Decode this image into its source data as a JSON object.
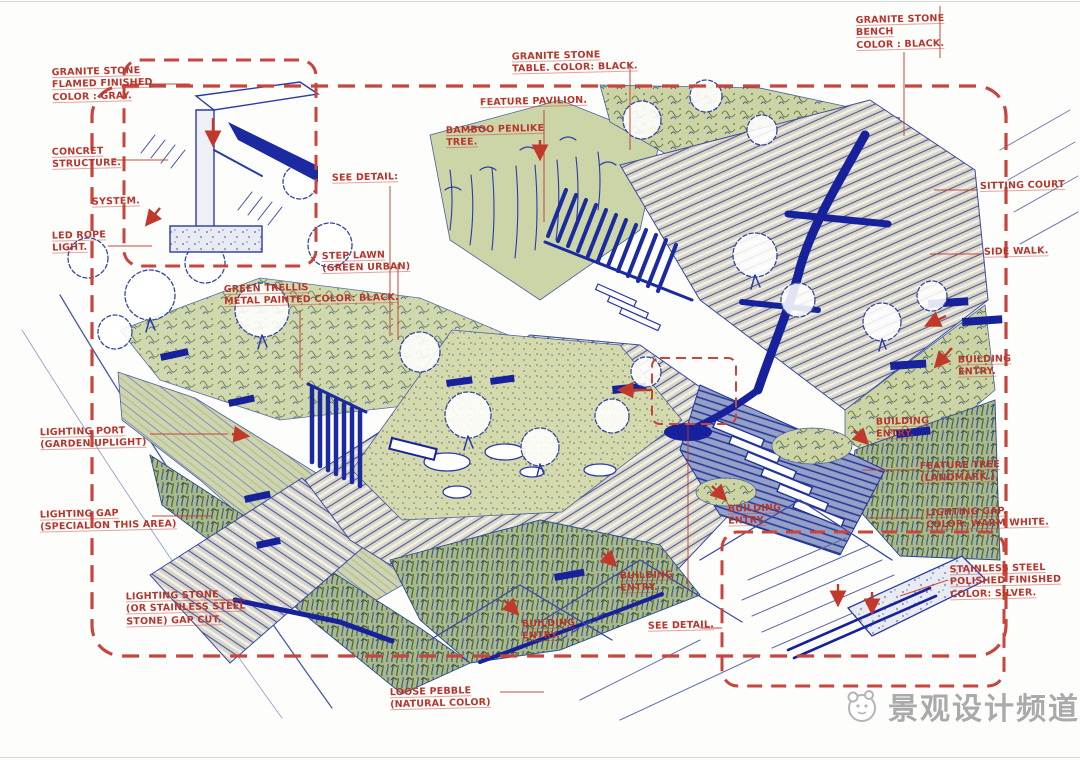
{
  "annotations": {
    "granite_flamed": "GRANITE STONE\nFLAMED FINISHED\nCOLOR : GRAY.",
    "concrete_structure": "CONCRET\nSTRUCTURE.",
    "system": "SYSTEM.",
    "led_rope": "LED ROPE\nLIGHT.",
    "see_detail_left": "SEE DETAIL:",
    "step_lawn": "STEP LAWN\n(GREEN URBAN)",
    "green_trellis": "GREEN TRELLIS\nMETAL PAINTED COLOR: BLACK.",
    "granite_table": "GRANITE STONE\nTABLE. COLOR: BLACK.",
    "feature_pavilion": "FEATURE PAVILION.",
    "bamboo_tree": "BAMBOO PENLIKE\nTREE.",
    "granite_bench": "GRANITE STONE\nBENCH\nCOLOR : BLACK.",
    "sitting_court": "SITTING COURT",
    "side_walk": "SIDE WALK.",
    "building_entry_r1": "BUILDING\nENTRY.",
    "building_entry_r2": "BUILDING\nENTRY.",
    "feature_tree": "FEATURE TREE\n(LANDMARK.)",
    "lighting_gap_warm": "LIGHTING GAP.\nCOLOR: WARM WHITE.",
    "stainless_steel": "STAINLESS STEEL\nPOLISHED FINISHED\nCOLOR: SILVER.",
    "building_entry_c1": "BUILDING\nENTRY.",
    "building_entry_c2": "BUILDING\nENTRY.",
    "building_entry_c3": "BUILDING\nENTRY.",
    "see_detail_bottom": "SEE DETAIL.",
    "loose_pebble": "LOOSE PEBBLE\n(NATURAL COLOR)",
    "lighting_port": "LIGHTING PORT\n(GARDEN UPLIGHT)",
    "lighting_gap_special": "LIGHTING GAP\n(SPECIAL ON THIS AREA)",
    "lighting_stone": "LIGHTING STONE\n(OR STAINLESS STEEL\nSTONE) GAP CUT."
  },
  "watermark": {
    "text": "景观设计频道"
  },
  "colors": {
    "annotation_red": "#b6352c",
    "ink_blue": "#3142a3",
    "water_navy": "#16219b",
    "foliage_green": "#ccd4a6",
    "deck_tan": "#dcd8c6",
    "watermark_gray": "#aaaaaa"
  }
}
